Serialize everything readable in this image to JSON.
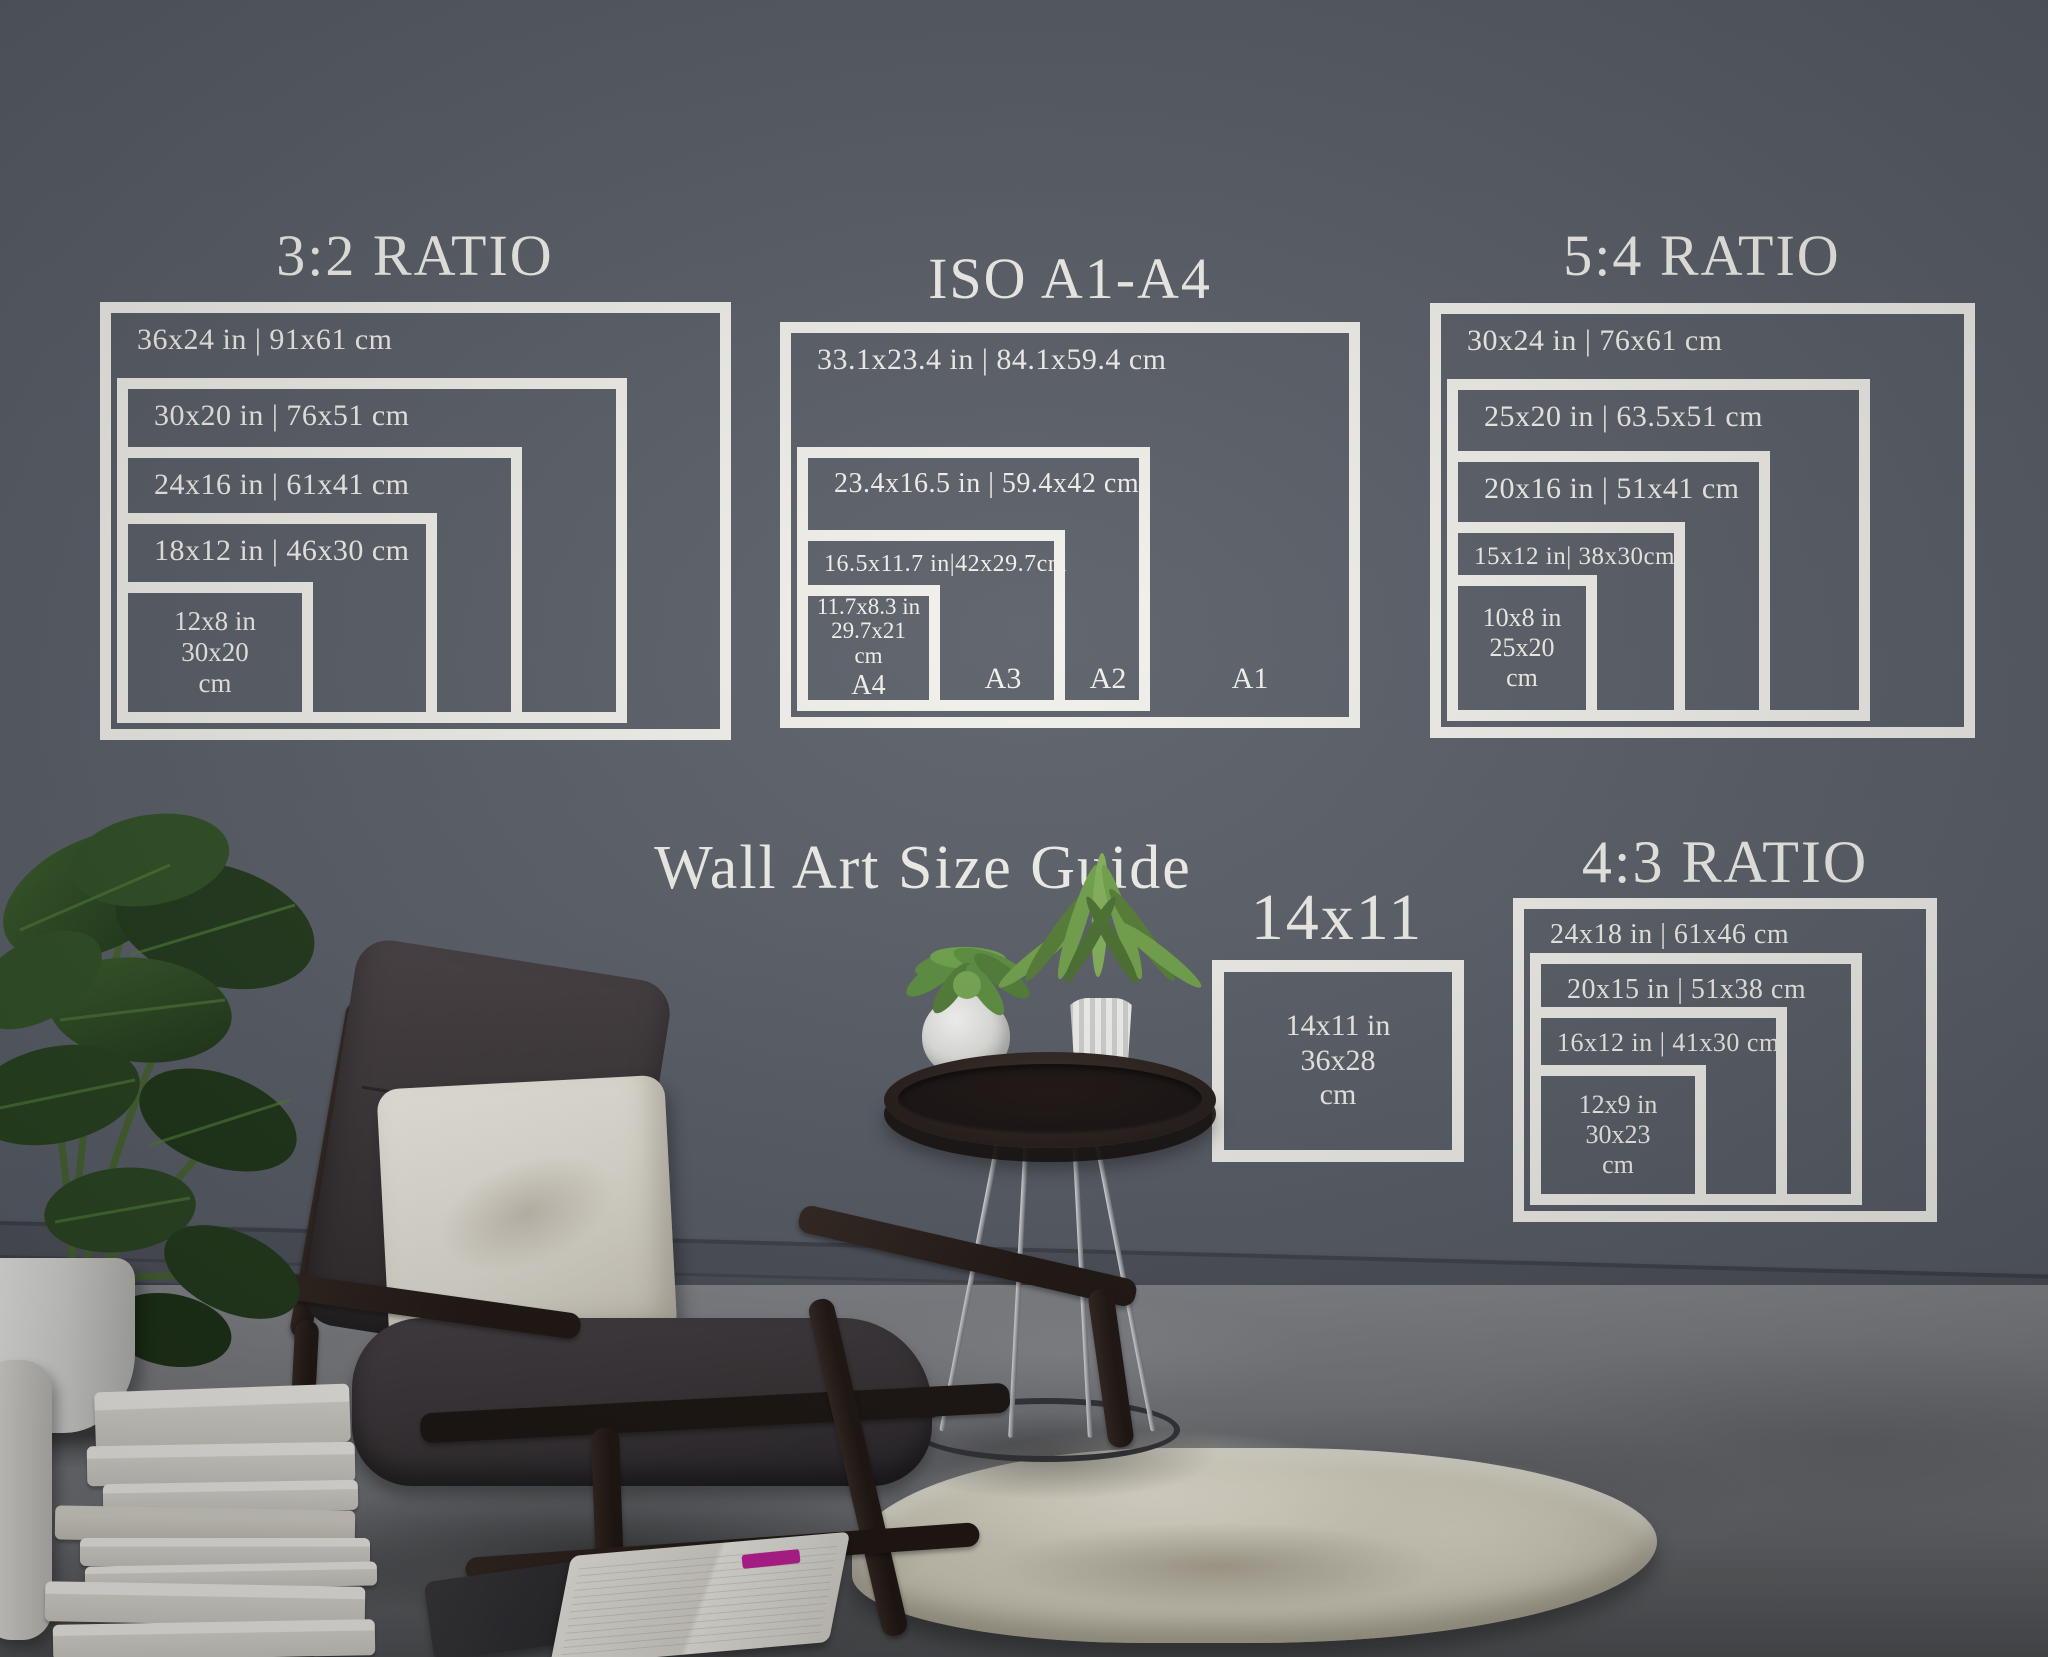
{
  "page": {
    "main_title": "Wall Art Size Guide"
  },
  "colors": {
    "wall": "#5a5f68",
    "diagram_line": "#f2f1ec",
    "floor": "#7c7f84",
    "baseboard": "#4d515a",
    "wood": "#2a201c",
    "cushion": "#3b3538",
    "pillow": "#e9e5dc",
    "rug": "#d6d1c0",
    "plant_green": "#2c4a22",
    "chrome": "#cfd2d6",
    "book_white": "#eceae5",
    "bookmark_magenta": "#c2209a"
  },
  "sections": {
    "ratio32": {
      "title": "3:2 RATIO",
      "frames": [
        "36x24 in | 91x61 cm",
        "30x20 in | 76x51 cm",
        "24x16 in | 61x41 cm",
        "18x12 in | 46x30 cm"
      ],
      "small": {
        "l1": "12x8 in",
        "l2": "30x20",
        "l3": "cm"
      }
    },
    "iso": {
      "title": "ISO A1-A4",
      "frames": [
        "33.1x23.4 in | 84.1x59.4 cm",
        "23.4x16.5 in | 59.4x42 cm",
        "16.5x11.7 in|42x29.7cm"
      ],
      "small": {
        "l1": "11.7x8.3 in",
        "l2": "29.7x21",
        "l3": "cm"
      },
      "labels": [
        "A4",
        "A3",
        "A2",
        "A1"
      ]
    },
    "ratio54": {
      "title": "5:4 RATIO",
      "frames": [
        "30x24 in | 76x61 cm",
        "25x20 in | 63.5x51 cm",
        "20x16 in | 51x41 cm",
        "15x12 in| 38x30cm"
      ],
      "small": {
        "l1": "10x8 in",
        "l2": "25x20",
        "l3": "cm"
      }
    },
    "s1411": {
      "title": "14x11",
      "small": {
        "l1": "14x11 in",
        "l2": "36x28",
        "l3": "cm"
      }
    },
    "ratio43": {
      "title": "4:3 RATIO",
      "frames": [
        "24x18 in | 61x46 cm",
        "20x15 in | 51x38 cm",
        "16x12 in | 41x30 cm"
      ],
      "small": {
        "l1": "12x9 in",
        "l2": "30x23",
        "l3": "cm"
      }
    }
  }
}
